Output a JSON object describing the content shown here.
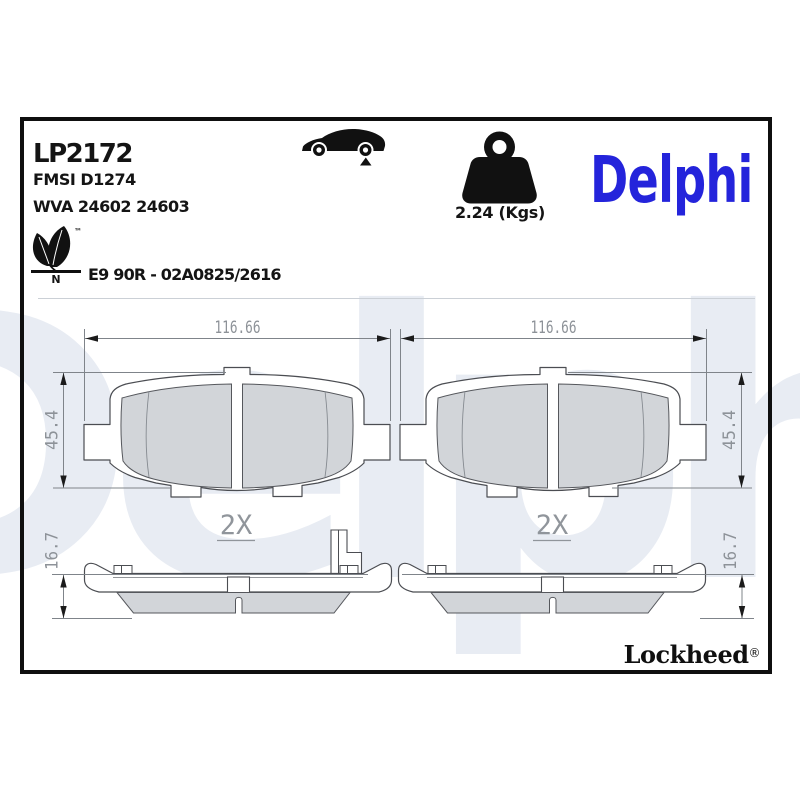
{
  "header": {
    "part_number": "LP2172",
    "fmsi_line": "FMSI D1274",
    "wva_line": "WVA 24602 24603",
    "homologation": "E9 90R - 02A0825/2616",
    "weight_value": "2.24 (Kgs)"
  },
  "branding": {
    "delphi_logo": "Delphi",
    "lockheed_logo": "Lockheed",
    "registered_symbol": "®",
    "trademark_symbol": "™",
    "eco_label_letter": "N",
    "watermark_text": "Delphi"
  },
  "icons": {
    "vehicle": "car-side-silhouette-with-rear-axle-marker",
    "weight": "kettlebell-weight",
    "eco": "leaf-logo"
  },
  "drawings": {
    "front_left": {
      "width": "116.66",
      "height": "45.4",
      "qty": "2X"
    },
    "front_right": {
      "width": "116.66",
      "height": "45.4",
      "qty": "2X"
    },
    "side_left": {
      "height": "16.7"
    },
    "side_right": {
      "height": "16.7"
    }
  },
  "colors": {
    "delphi_blue": "#2424DB",
    "watermark_blue": "#E8ECF3",
    "pad_fill_gray": "#D2D5D9",
    "outline_gray": "#4B4D52",
    "dimension_gray": "#8D9298",
    "frame_black": "#0F0F0F"
  }
}
